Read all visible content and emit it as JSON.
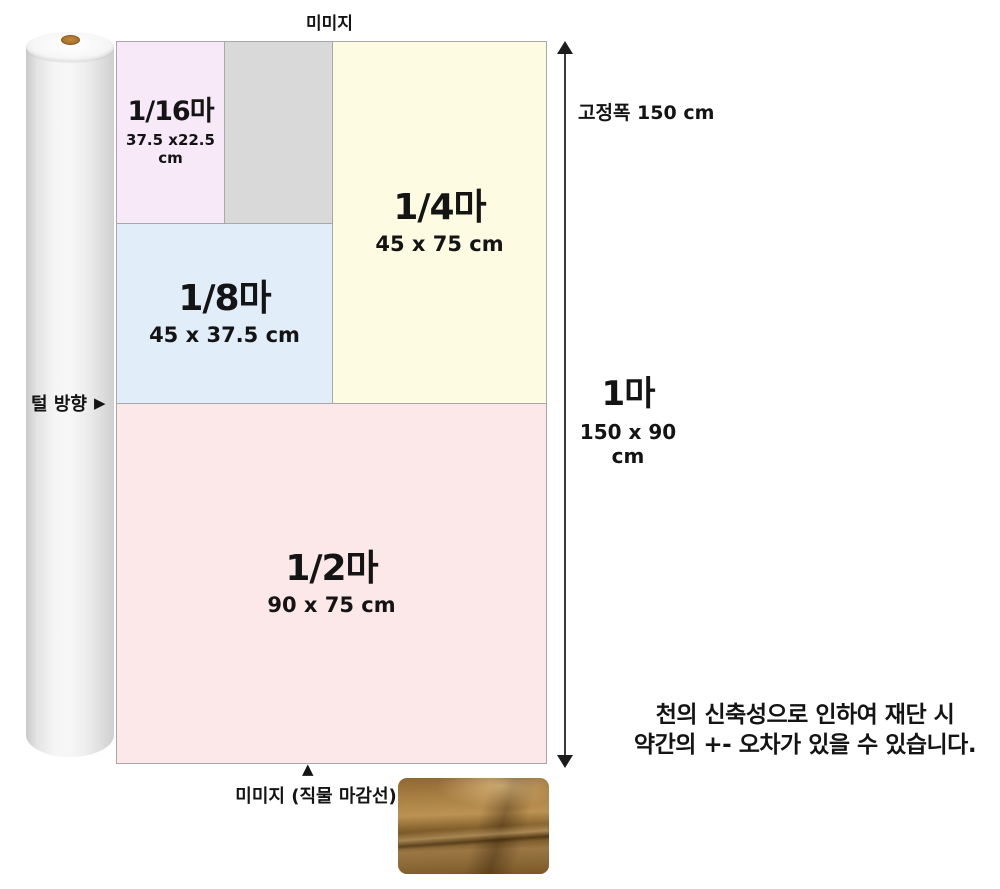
{
  "diagram": {
    "top_selvage_label": "미미지",
    "fixed_width_label": "고정폭 150 cm",
    "nap_direction_label": "털 방향",
    "bottom_selvage_label": "미미지 (직물 마감선)",
    "full_width": {
      "title": "1마",
      "dims": "150 x 90 cm"
    },
    "pieces": {
      "p16": {
        "title": "1/16마",
        "dims": "37.5 x22.5 cm",
        "color": "#f7e9f8"
      },
      "p8": {
        "title": "1/8마",
        "dims": "45 x 37.5 cm",
        "color": "#e2edfa"
      },
      "p4": {
        "title": "1/4마",
        "dims": "45 x 75 cm",
        "color": "#fdfce3"
      },
      "p2": {
        "title": "1/2마",
        "dims": "90 x 75 cm",
        "color": "#fce8e8"
      }
    },
    "leftover_color": "#d9d9d9",
    "note": {
      "line1": "천의 신축성으로 인하여 재단 시",
      "line2": "약간의 +- 오차가 있을 수 있습니다."
    },
    "markers": {
      "up_triangle": "▲",
      "right_triangle": "▶"
    },
    "colors": {
      "arrow": "#1c1c1c",
      "box_border": "#a8a8a8",
      "text": "#141414",
      "roll_core_brown": "#a96f27",
      "fabric_photo_brown": "#8f6733"
    }
  }
}
